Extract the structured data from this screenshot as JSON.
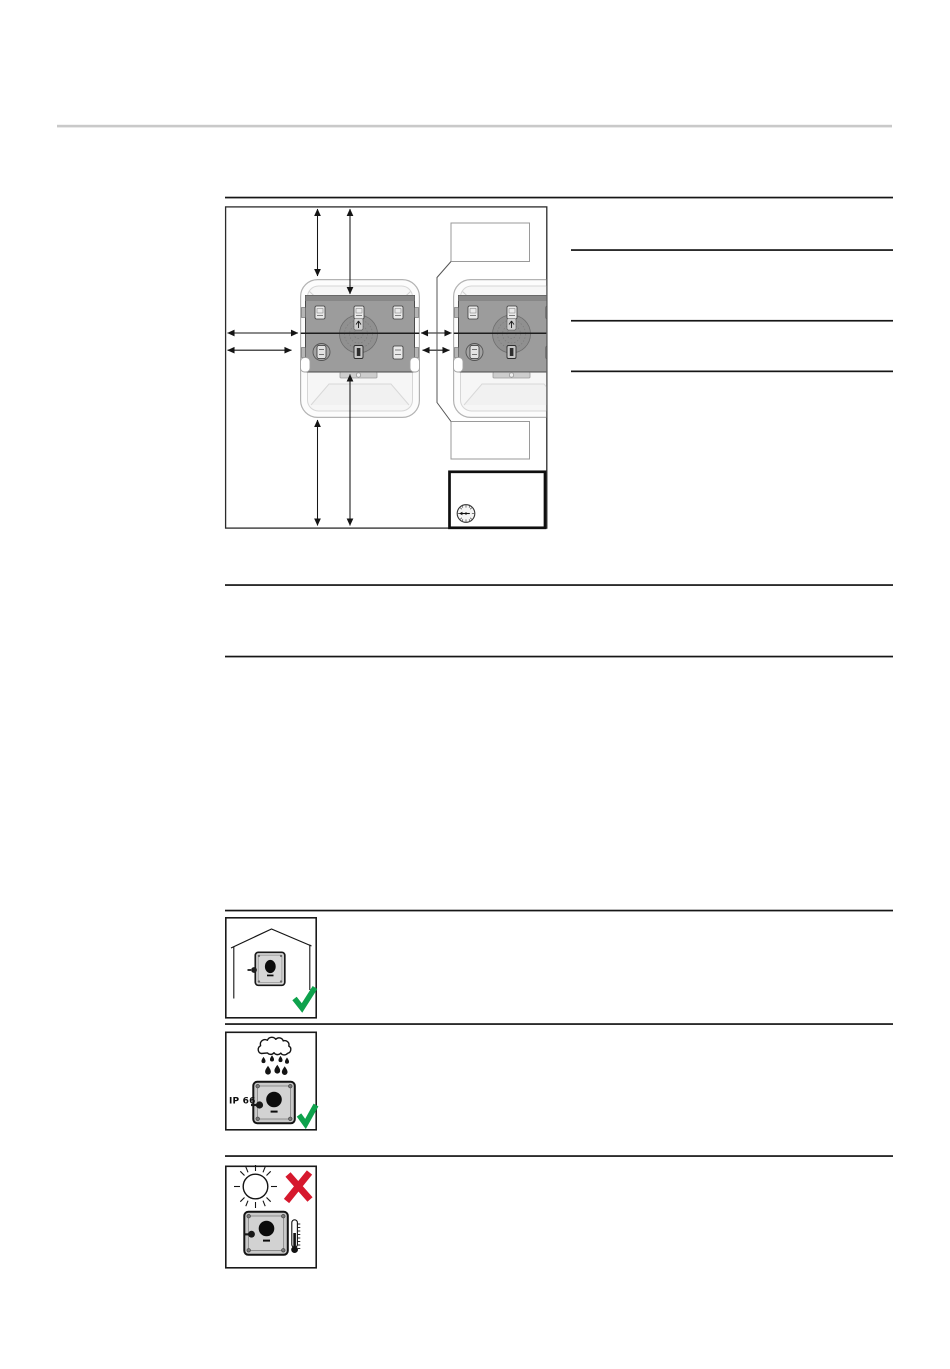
{
  "page": {
    "kind": "installation-manual-page",
    "background": "#ffffff"
  },
  "colors": {
    "page_bg": "#ffffff",
    "rule_gray": "#c9c9c9",
    "line_black": "#161616",
    "frame_stroke": "#2b2b2b",
    "callout_stroke": "#9a9a9a",
    "icon_box_stroke": "#1a1a1a",
    "housing_stroke": "#b3b3b3",
    "plate_fill": "#9c9c9c",
    "plate_stroke": "#4a4a4a",
    "clip_fill": "#e9e9e9",
    "small_device_fill": "#d7d7d7",
    "medium_device_fill": "#c9c9c9",
    "check_green": "#0ea24c",
    "cross_red": "#d6182d"
  },
  "figure": {
    "name": "mounting-clearance-diagram",
    "devices": [
      "wallbox-left",
      "wallbox-right-clipped"
    ],
    "clearance_arrows": 8,
    "callout_boxes": [
      "empty-top",
      "empty-bottom"
    ],
    "corner_icon": "dial-gauge-icon"
  },
  "location_suitability": {
    "rows": [
      {
        "pictogram": "device-indoors-house-icon",
        "result_icon": "green-checkmark-icon"
      },
      {
        "pictogram": "rain-cloud-device-icon",
        "ip_label": "IP 66",
        "result_icon": "green-checkmark-icon"
      },
      {
        "pictogram": "direct-sunlight-device-icon",
        "result_icon": "red-cross-icon",
        "extra_icon": "thermometer-icon"
      }
    ]
  }
}
